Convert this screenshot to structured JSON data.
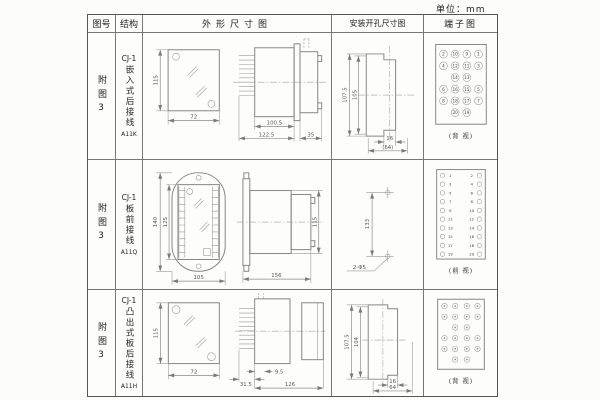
{
  "page": {
    "unit_label": "单位：mm"
  },
  "header": {
    "figure": "图号",
    "structure": "结构",
    "outline": "外形尺寸图",
    "install": "安装开孔尺寸图",
    "terminal": "端子图"
  },
  "rows": [
    {
      "figure": "附图3",
      "structure": {
        "model": "CJ-1",
        "desc": "嵌入式后接线",
        "code": "A11K"
      },
      "outline": {
        "h": "115",
        "w": "72",
        "d1": "100.5",
        "d2": "122.5",
        "d3": "35"
      },
      "install": {
        "v1": "107.5",
        "v2": "105",
        "h1": "16",
        "h2": "(64)"
      },
      "terminal": {
        "view": "(背 视)",
        "grid": [
          [
            "2",
            "10",
            "9",
            "1"
          ],
          [
            "4",
            "12",
            "11",
            "3"
          ],
          [
            "14",
            "13"
          ],
          [
            "6",
            "16",
            "15",
            "5"
          ],
          [
            "8",
            "18",
            "17",
            "7"
          ],
          [
            "20",
            "19"
          ]
        ]
      }
    },
    {
      "figure": "附图3",
      "structure": {
        "model": "CJ-1",
        "desc": "板前接线",
        "code": "A11Q"
      },
      "outline": {
        "h1": "140",
        "h2": "125",
        "w": "105",
        "d1": "156",
        "d2": "115"
      },
      "install": {
        "v1": "133",
        "hole": "2-Φ5"
      },
      "terminal": {
        "view": "(前 视)",
        "pairs": [
          [
            "1",
            "2"
          ],
          [
            "3",
            "4"
          ],
          [
            "5",
            "6"
          ],
          [
            "7",
            "8"
          ],
          [
            "9",
            "10"
          ],
          [
            "11",
            "12"
          ],
          [
            "13",
            "14"
          ],
          [
            "15",
            "16"
          ],
          [
            "17",
            "18"
          ],
          [
            "19",
            "20"
          ]
        ]
      }
    },
    {
      "figure": "附图3",
      "structure": {
        "model": "CJ-1",
        "desc": "凸出式板后接线",
        "code": "A11H"
      },
      "outline": {
        "h": "115",
        "w": "72",
        "d1": "31.5",
        "d2": "9.5",
        "d3": "126"
      },
      "install": {
        "v1": "107.5",
        "v2": "104",
        "h1": "16",
        "h2": "64"
      },
      "terminal": {
        "view": "(背 视)"
      }
    }
  ]
}
